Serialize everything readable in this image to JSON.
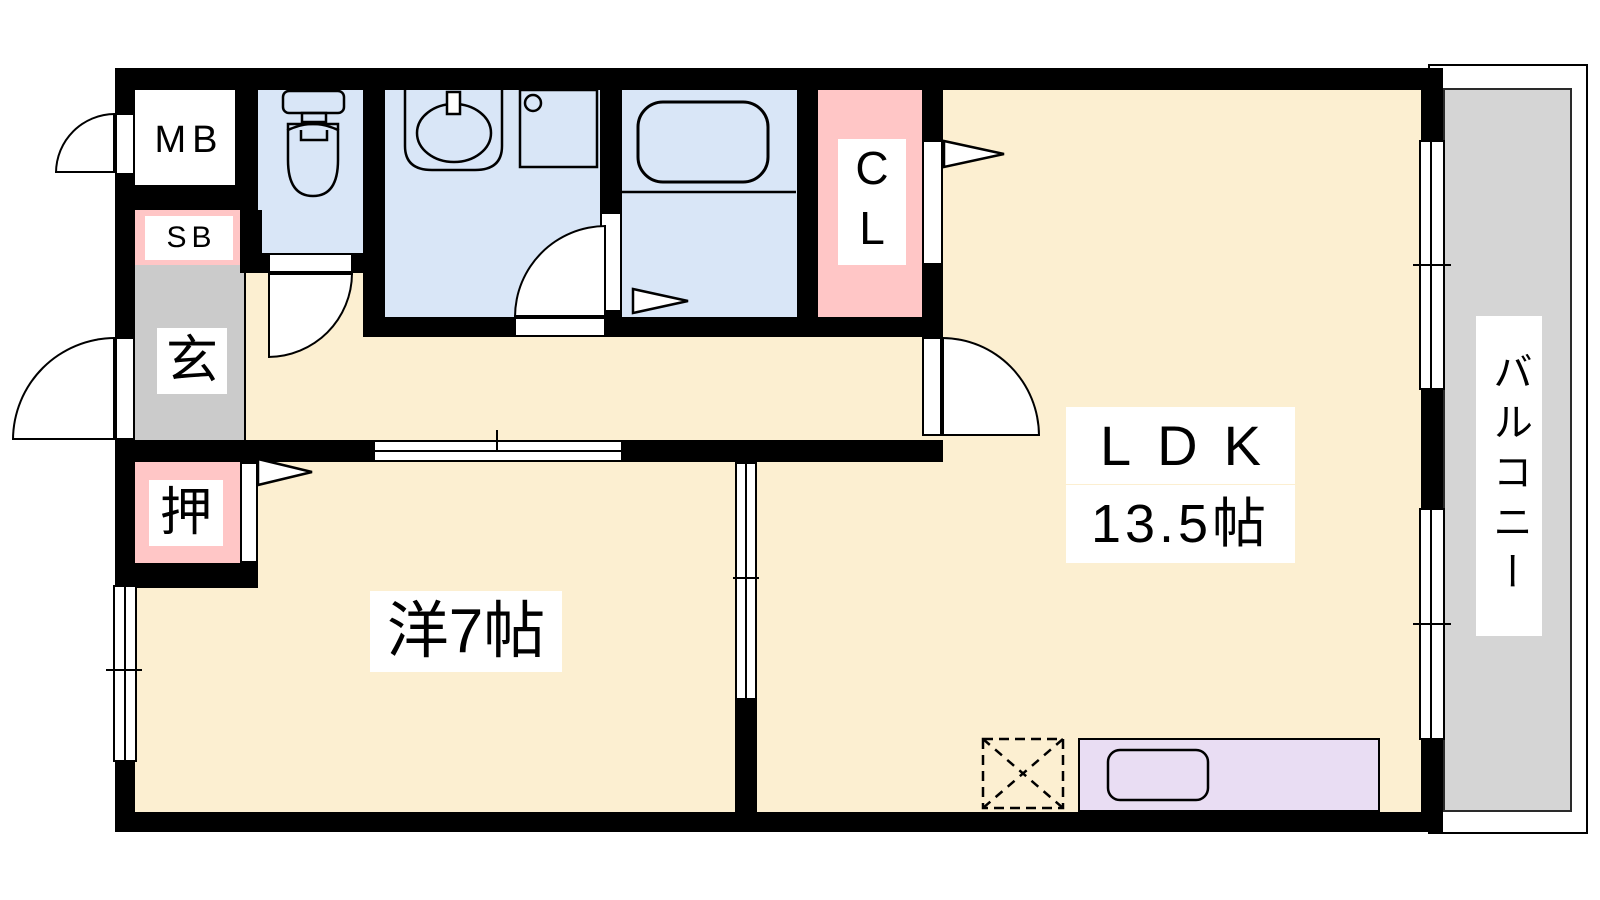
{
  "labels": {
    "meter_box": "MB",
    "shoe_box": "SB",
    "entrance": "玄",
    "oshiire_closet": "押",
    "closet": "CL",
    "ldk": "LDK",
    "ldk_size": "13.5帖",
    "western_room": "洋7帖",
    "balcony": "バルコニー"
  },
  "colors": {
    "floor_cream": "#FCEFD1",
    "wet_area_blue": "#D9E6F7",
    "closet_pink": "#FFC6C6",
    "entrance_gray": "#CBCBCB",
    "balcony_gray": "#D5D5D5",
    "kitchen_counter_purple": "#E9DDF3",
    "wall_black": "#000000"
  }
}
